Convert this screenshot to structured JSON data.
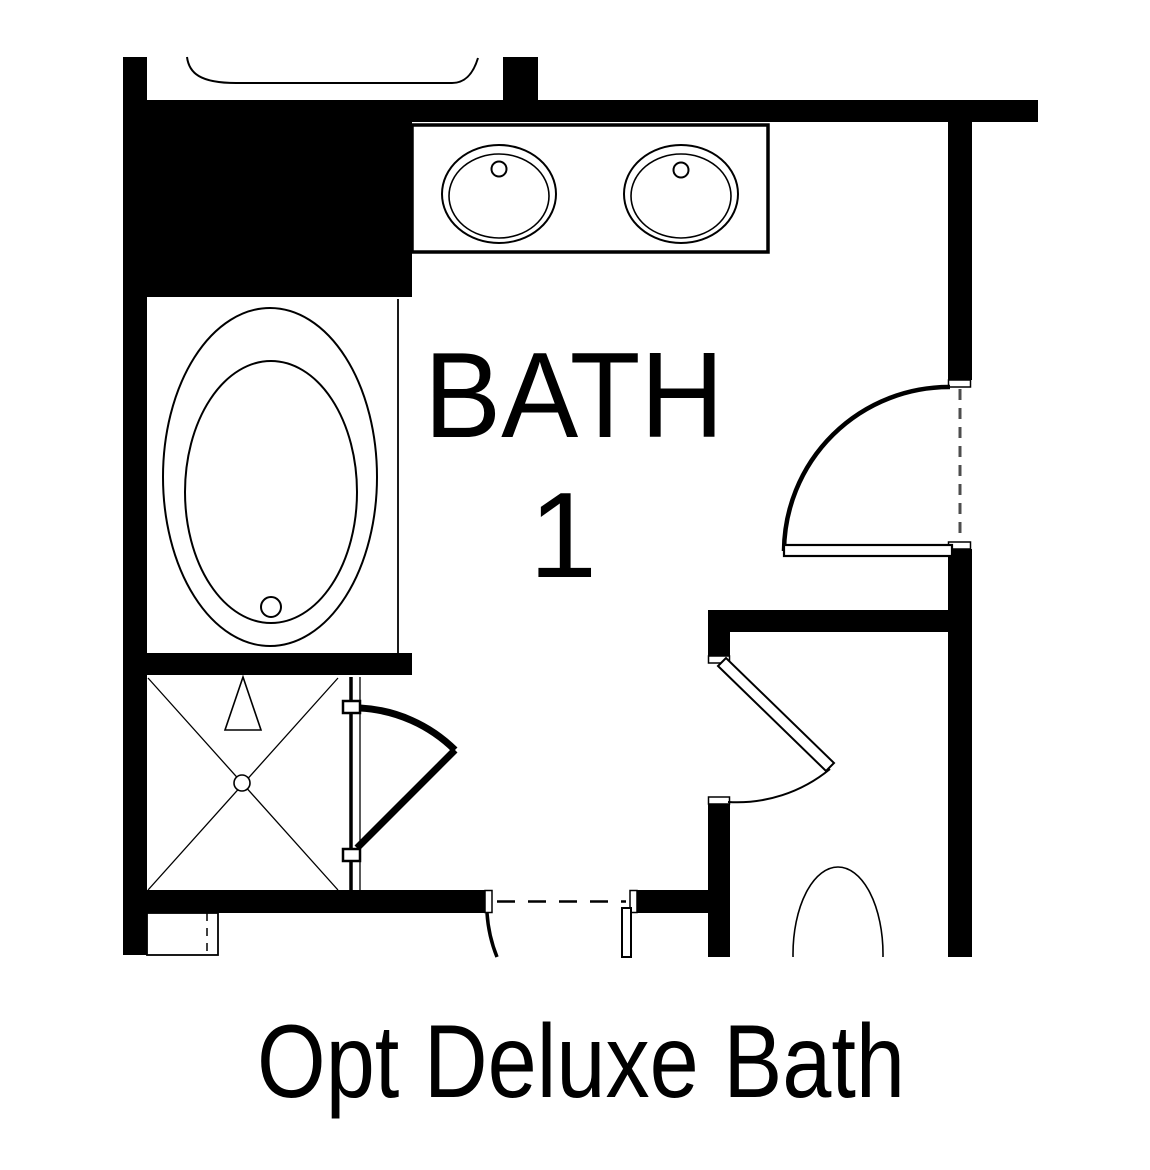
{
  "labels": {
    "room_name": "BATH",
    "room_number": "1",
    "caption": "Opt Deluxe Bath"
  },
  "colors": {
    "ink": "#000000",
    "paper": "#ffffff",
    "opening-dash": "#4d4d4d"
  }
}
